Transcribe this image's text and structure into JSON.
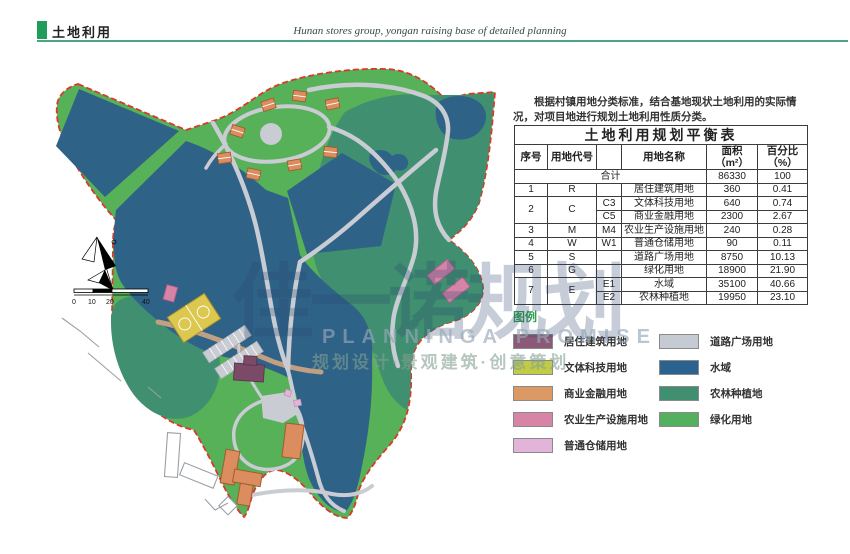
{
  "header": {
    "title": "土地利用",
    "subtitle": "Hunan stores group, yongan raising base of detailed planning"
  },
  "intro": "根据村镇用地分类标准，结合基地现状土地利用的实际情况，对项目地进行规划土地利用性质分类。",
  "table": {
    "title": "土地利用规划平衡表",
    "headers": [
      "序号",
      "用地代号",
      "",
      "用地名称",
      "面积（m²）",
      "百分比\n（%）"
    ],
    "rows": [
      {
        "cells": [
          {
            "t": "合计",
            "cs": 4
          },
          {
            "t": "86330"
          },
          {
            "t": "100"
          }
        ]
      },
      {
        "cells": [
          {
            "t": "1"
          },
          {
            "t": "R"
          },
          {
            "t": ""
          },
          {
            "t": "居住建筑用地"
          },
          {
            "t": "360"
          },
          {
            "t": "0.41"
          }
        ]
      },
      {
        "cells": [
          {
            "t": "2",
            "rs": 2
          },
          {
            "t": "C",
            "rs": 2
          },
          {
            "t": "C3"
          },
          {
            "t": "文体科技用地"
          },
          {
            "t": "640"
          },
          {
            "t": "0.74"
          }
        ]
      },
      {
        "cells": [
          {
            "t": "C5"
          },
          {
            "t": "商业金融用地"
          },
          {
            "t": "2300"
          },
          {
            "t": "2.67"
          }
        ]
      },
      {
        "cells": [
          {
            "t": "3"
          },
          {
            "t": "M"
          },
          {
            "t": "M4"
          },
          {
            "t": "农业生产设施用地"
          },
          {
            "t": "240"
          },
          {
            "t": "0.28"
          }
        ]
      },
      {
        "cells": [
          {
            "t": "4"
          },
          {
            "t": "W"
          },
          {
            "t": "W1"
          },
          {
            "t": "普通仓储用地"
          },
          {
            "t": "90"
          },
          {
            "t": "0.11"
          }
        ]
      },
      {
        "cells": [
          {
            "t": "5"
          },
          {
            "t": "S"
          },
          {
            "t": ""
          },
          {
            "t": "道路广场用地"
          },
          {
            "t": "8750"
          },
          {
            "t": "10.13"
          }
        ]
      },
      {
        "cells": [
          {
            "t": "6"
          },
          {
            "t": "G"
          },
          {
            "t": ""
          },
          {
            "t": "绿化用地"
          },
          {
            "t": "18900"
          },
          {
            "t": "21.90"
          }
        ]
      },
      {
        "cells": [
          {
            "t": "7",
            "rs": 2
          },
          {
            "t": "E",
            "rs": 2
          },
          {
            "t": "E1"
          },
          {
            "t": "水域"
          },
          {
            "t": "35100"
          },
          {
            "t": "40.66"
          }
        ]
      },
      {
        "cells": [
          {
            "t": "E2"
          },
          {
            "t": "农林种植地"
          },
          {
            "t": "19950"
          },
          {
            "t": "23.10"
          }
        ]
      }
    ]
  },
  "legend": {
    "title": "图例",
    "left": [
      {
        "label": "居住建筑用地",
        "color": "#8c5a76"
      },
      {
        "label": "文体科技用地",
        "color": "#c2cb45"
      },
      {
        "label": "商业金融用地",
        "color": "#dc9963"
      },
      {
        "label": "农业生产设施用地",
        "color": "#d884a6"
      },
      {
        "label": "普通仓储用地",
        "color": "#e3b4d9"
      }
    ],
    "right": [
      {
        "label": "道路广场用地",
        "color": "#c6cad3"
      },
      {
        "label": "水域",
        "color": "#2c628f"
      },
      {
        "label": "农林种植地",
        "color": "#3f8f70"
      },
      {
        "label": "绿化用地",
        "color": "#53b05e"
      }
    ]
  },
  "watermark": {
    "big": "佳一诺规划",
    "en": "PLANNINGA  PROMISE",
    "cn": "规划设计·景观建筑·创意策划"
  },
  "map": {
    "scale": {
      "labels": [
        "0",
        "10",
        "20",
        "40"
      ]
    }
  },
  "colors": {
    "accent_green": "#1f9e5a",
    "header_line": "#4da383",
    "legend_title_green": "#2f9e52",
    "map_green": "#56b158",
    "map_teal": "#3f8f70",
    "map_water": "#2e6287",
    "map_road": "#c9ccd2",
    "boundary_red": "#da382a",
    "house_orange": "#dc8d60",
    "court_yellow": "#ddc84f",
    "residential_purple": "#7b4a66",
    "facility_pink": "#d584a8",
    "storage_pink": "#e3b4d9",
    "tan_road": "#c09f82"
  }
}
